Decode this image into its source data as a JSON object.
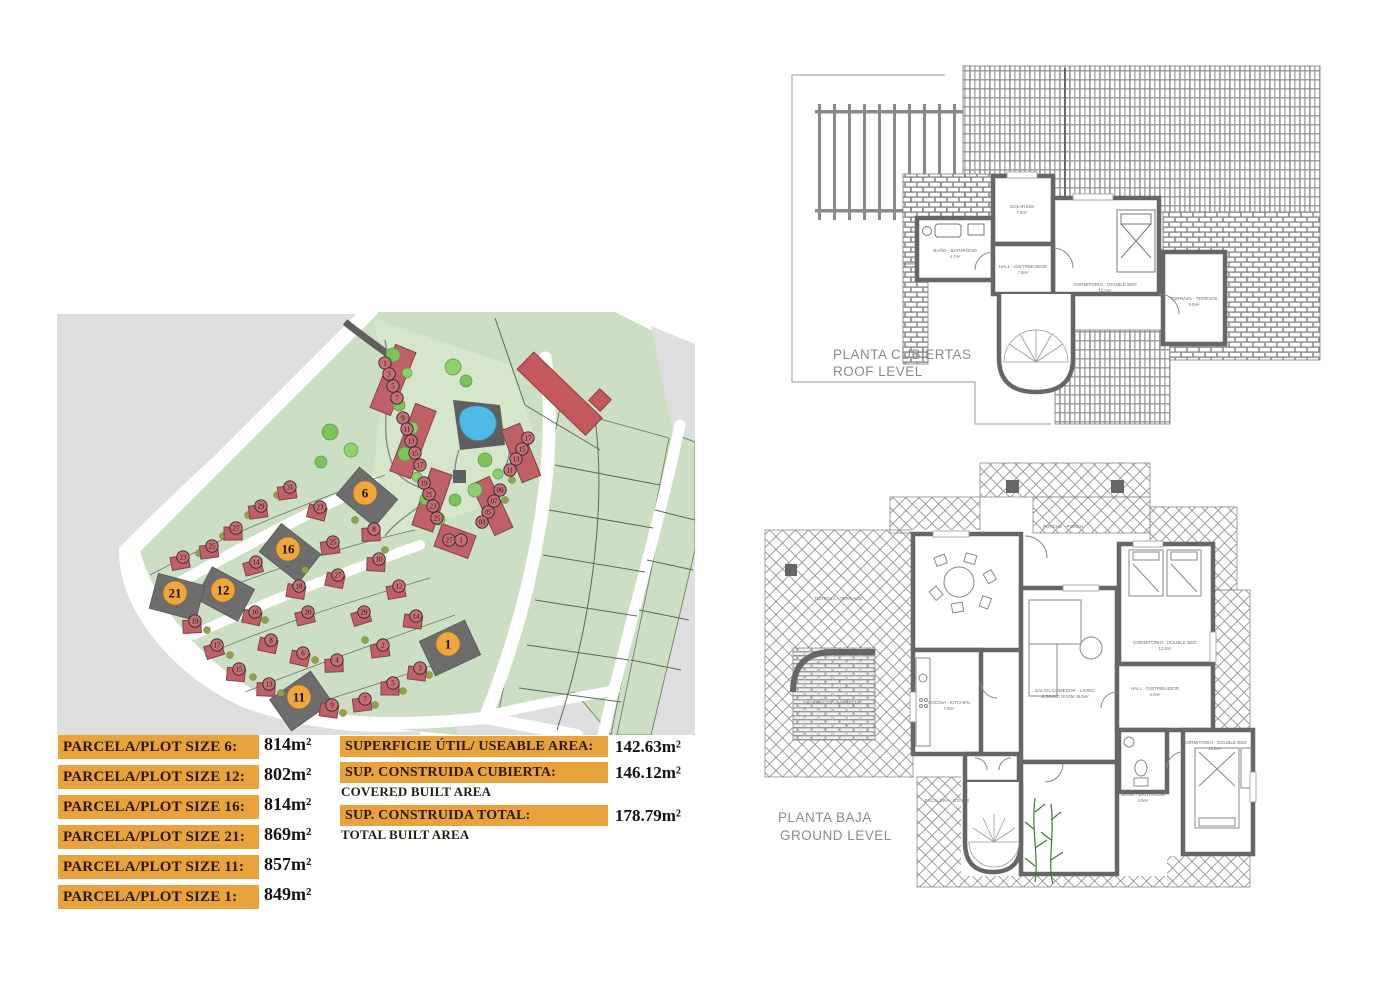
{
  "plot_table": {
    "rows": [
      {
        "label": "PARCELA/PLOT SIZE 6:",
        "value": "814m²"
      },
      {
        "label": "PARCELA/PLOT SIZE 12:",
        "value": "802m²"
      },
      {
        "label": "PARCELA/PLOT SIZE 16:",
        "value": "814m²"
      },
      {
        "label": "PARCELA/PLOT SIZE 21:",
        "value": "869m²"
      },
      {
        "label": "PARCELA/PLOT SIZE 11:",
        "value": "857m²"
      },
      {
        "label": "PARCELA/PLOT SIZE 1:",
        "value": "849m²"
      }
    ]
  },
  "area_table": {
    "rows": [
      {
        "label": "SUPERFICIE ÚTIL/ USEABLE AREA:",
        "sublabel": "",
        "value": "142.63m²"
      },
      {
        "label": "SUP. CONSTRUIDA CUBIERTA:",
        "sublabel": "COVERED BUILT AREA",
        "value": "146.12m²"
      },
      {
        "label": "SUP. CONSTRUIDA TOTAL:",
        "sublabel": "TOTAL BUILT AREA",
        "value": "178.79m²"
      }
    ]
  },
  "site_plan": {
    "highlighted_plots": [
      {
        "n": "6",
        "x": 310,
        "y": 183,
        "rot": 40
      },
      {
        "n": "16",
        "x": 233,
        "y": 239,
        "rot": 38
      },
      {
        "n": "12",
        "x": 168,
        "y": 280,
        "rot": 28
      },
      {
        "n": "21",
        "x": 120,
        "y": 283,
        "rot": 15
      },
      {
        "n": "11",
        "x": 244,
        "y": 387,
        "rot": -35
      },
      {
        "n": "1",
        "x": 393,
        "y": 334,
        "rot": -25
      }
    ],
    "numbered_plots": [
      {
        "n": "1",
        "x": 330,
        "y": 53,
        "t": "s"
      },
      {
        "n": "3",
        "x": 334,
        "y": 64,
        "t": "s"
      },
      {
        "n": "5",
        "x": 338,
        "y": 76,
        "t": "s"
      },
      {
        "n": "7",
        "x": 342,
        "y": 88,
        "t": "s"
      },
      {
        "n": "9",
        "x": 348,
        "y": 108,
        "t": "s"
      },
      {
        "n": "11",
        "x": 352,
        "y": 119,
        "t": "s"
      },
      {
        "n": "13",
        "x": 356,
        "y": 131,
        "t": "s"
      },
      {
        "n": "15",
        "x": 360,
        "y": 143,
        "t": "s"
      },
      {
        "n": "17",
        "x": 365,
        "y": 155,
        "t": "s"
      },
      {
        "n": "19",
        "x": 369,
        "y": 173,
        "t": "s"
      },
      {
        "n": "21",
        "x": 374,
        "y": 184,
        "t": "s"
      },
      {
        "n": "23",
        "x": 378,
        "y": 196,
        "t": "s"
      },
      {
        "n": "25",
        "x": 382,
        "y": 208,
        "t": "s"
      },
      {
        "n": "27",
        "x": 394,
        "y": 230,
        "t": "s"
      },
      {
        "n": "1",
        "x": 406,
        "y": 230,
        "t": "s"
      },
      {
        "n": "17",
        "x": 473,
        "y": 128,
        "t": "s"
      },
      {
        "n": "15",
        "x": 467,
        "y": 139,
        "t": "s"
      },
      {
        "n": "13",
        "x": 461,
        "y": 149,
        "t": "s"
      },
      {
        "n": "11",
        "x": 455,
        "y": 160,
        "t": "s"
      },
      {
        "n": "09",
        "x": 445,
        "y": 180,
        "t": "s"
      },
      {
        "n": "07",
        "x": 439,
        "y": 191,
        "t": "s"
      },
      {
        "n": "05",
        "x": 433,
        "y": 202,
        "t": "s"
      },
      {
        "n": "03",
        "x": 427,
        "y": 212,
        "t": "s"
      },
      {
        "n": "31",
        "x": 235,
        "y": 177,
        "t": "h"
      },
      {
        "n": "29",
        "x": 206,
        "y": 196,
        "t": "h"
      },
      {
        "n": "27",
        "x": 181,
        "y": 218,
        "t": "h"
      },
      {
        "n": "25",
        "x": 157,
        "y": 236,
        "t": "h"
      },
      {
        "n": "23",
        "x": 128,
        "y": 247,
        "t": "h"
      },
      {
        "n": "19",
        "x": 140,
        "y": 311,
        "t": "h"
      },
      {
        "n": "17",
        "x": 162,
        "y": 335,
        "t": "h"
      },
      {
        "n": "15",
        "x": 184,
        "y": 359,
        "t": "h"
      },
      {
        "n": "13",
        "x": 214,
        "y": 374,
        "t": "h"
      },
      {
        "n": "9",
        "x": 277,
        "y": 395,
        "t": "h"
      },
      {
        "n": "7",
        "x": 310,
        "y": 389,
        "t": "h"
      },
      {
        "n": "5",
        "x": 338,
        "y": 373,
        "t": "h"
      },
      {
        "n": "3",
        "x": 365,
        "y": 358,
        "t": "h"
      },
      {
        "n": "14",
        "x": 201,
        "y": 252,
        "t": "h"
      },
      {
        "n": "18",
        "x": 244,
        "y": 276,
        "t": "h"
      },
      {
        "n": "10",
        "x": 200,
        "y": 302,
        "t": "h"
      },
      {
        "n": "20",
        "x": 253,
        "y": 302,
        "t": "h"
      },
      {
        "n": "8",
        "x": 216,
        "y": 330,
        "t": "h"
      },
      {
        "n": "6",
        "x": 248,
        "y": 343,
        "t": "h"
      },
      {
        "n": "4",
        "x": 282,
        "y": 350,
        "t": "h"
      },
      {
        "n": "2",
        "x": 328,
        "y": 335,
        "t": "h"
      },
      {
        "n": "23",
        "x": 265,
        "y": 197,
        "t": "h"
      },
      {
        "n": "25",
        "x": 278,
        "y": 232,
        "t": "h"
      },
      {
        "n": "8",
        "x": 319,
        "y": 219,
        "t": "h"
      },
      {
        "n": "10",
        "x": 324,
        "y": 249,
        "t": "h"
      },
      {
        "n": "27",
        "x": 283,
        "y": 265,
        "t": "h"
      },
      {
        "n": "29",
        "x": 309,
        "y": 302,
        "t": "h"
      },
      {
        "n": "12",
        "x": 344,
        "y": 276,
        "t": "h"
      },
      {
        "n": "14",
        "x": 361,
        "y": 306,
        "t": "h"
      }
    ]
  },
  "roof_plan": {
    "title": [
      "PLANTA CUBIERTAS",
      "ROOF LEVEL"
    ],
    "rooms": [
      {
        "name": "SOLARIUM",
        "area": "7.5m²",
        "x": 237,
        "y": 146
      },
      {
        "name": "BAÑO - BATHROOM",
        "area": "4.7m²",
        "x": 170,
        "y": 190
      },
      {
        "name": "HALL - DISTRIBUIDOR",
        "area": "7.8m²",
        "x": 238,
        "y": 206
      },
      {
        "name": "DORMITORIO - DOUBLE BED",
        "area": "15.2m²",
        "x": 320,
        "y": 224
      },
      {
        "name": "TERRAZA - TERRACE",
        "area": "9.0m²",
        "x": 409,
        "y": 238
      }
    ]
  },
  "ground_plan": {
    "title": [
      "PLANTA BAJA",
      "GROUND LEVEL"
    ],
    "rooms": [
      {
        "name": "PORCHE - PORCH",
        "area": "",
        "x": 300,
        "y": 76
      },
      {
        "name": "TERRAZA - TERRACE",
        "area": "",
        "x": 75,
        "y": 148
      },
      {
        "name": "BARBACOA - BARBECUE",
        "area": "",
        "x": 71,
        "y": 252
      },
      {
        "name": "COCINA - KITCHEN",
        "area": "7.5m²",
        "x": 186,
        "y": 252
      },
      {
        "name": "SALON COMEDOR - LIVING",
        "area": "& DINING ROOM  36.0m²",
        "x": 302,
        "y": 240
      },
      {
        "name": "DORMITORIO - DOUBLE BED",
        "area": "12.2m²",
        "x": 402,
        "y": 192
      },
      {
        "name": "HALL - DISTRIBUIDOR",
        "area": "4.0m²",
        "x": 392,
        "y": 238
      },
      {
        "name": "BAÑO - BATHROOM",
        "area": "4.5m²",
        "x": 380,
        "y": 344
      },
      {
        "name": "DORMITORIO - DOUBLE BED",
        "area": "12.6m²",
        "x": 452,
        "y": 292
      },
      {
        "name": "ESCALERA - STAIRS",
        "area": "",
        "x": 184,
        "y": 350
      }
    ]
  }
}
